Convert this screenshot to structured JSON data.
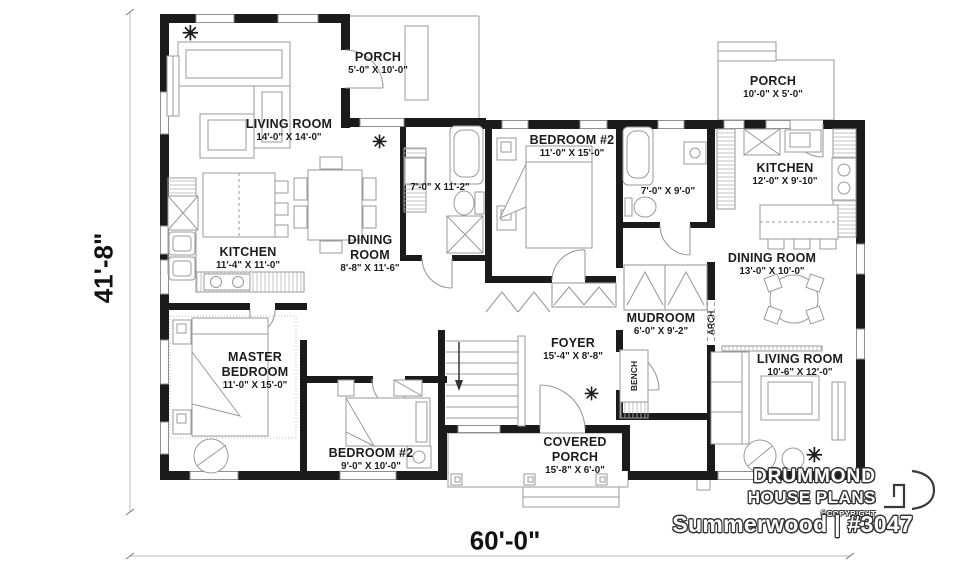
{
  "plan": {
    "title": "Summerwood | #3047",
    "brand": {
      "line1": "DRUMMOND",
      "line2": "HOUSE PLANS",
      "copyright": "©COPYRIGHT"
    },
    "dimensions": {
      "width": "60'-0\"",
      "height": "41'-8\""
    }
  },
  "rooms": {
    "living_left": {
      "name": "LIVING ROOM",
      "size": "14'-0\" X 14'-0\""
    },
    "porch_top": {
      "name": "PORCH",
      "size": "5'-0\" X 10'-0\""
    },
    "bath_main": {
      "size": "7'-0\" X 11'-2\""
    },
    "bedroom2_top": {
      "name": "BEDROOM #2",
      "size": "11'-0\" X 15'-0\""
    },
    "bath_right": {
      "size": "7'-0\" X 9'-0\""
    },
    "porch_right": {
      "name": "PORCH",
      "size": "10'-0\" X 5'-0\""
    },
    "kitchen_right": {
      "name": "KITCHEN",
      "size": "12'-0\" X 9'-10\""
    },
    "dining_right": {
      "name": "DINING ROOM",
      "size": "13'-0\" X 10'-0\""
    },
    "living_right": {
      "name": "LIVING ROOM",
      "size": "10'-6\" X 12'-0\""
    },
    "kitchen_left": {
      "name": "KITCHEN",
      "size": "11'-4\" X 11'-0\""
    },
    "dining_left": {
      "name1": "DINING",
      "name2": "ROOM",
      "size": "8'-8\" X 11'-6\""
    },
    "master": {
      "name1": "MASTER",
      "name2": "BEDROOM",
      "size": "11'-0\" X 15'-0\""
    },
    "bedroom2_bottom": {
      "name": "BEDROOM #2",
      "size": "9'-0\" X 10'-0\""
    },
    "mudroom": {
      "name": "MUDROOM",
      "size": "6'-0\" X 9'-2\""
    },
    "foyer": {
      "name": "FOYER",
      "size": "15'-4\" X 8'-8\""
    },
    "covered_porch": {
      "name1": "COVERED",
      "name2": "PORCH",
      "size": "15'-8\" X 6'-0\""
    }
  },
  "annotations": {
    "bench": "BENCH",
    "arch": "ARCH"
  },
  "icons": {
    "ceiling_fan": "✳"
  },
  "colors": {
    "wall": "#1b1b1b",
    "line": "#8f8f8f",
    "text": "#1c1c1c"
  }
}
